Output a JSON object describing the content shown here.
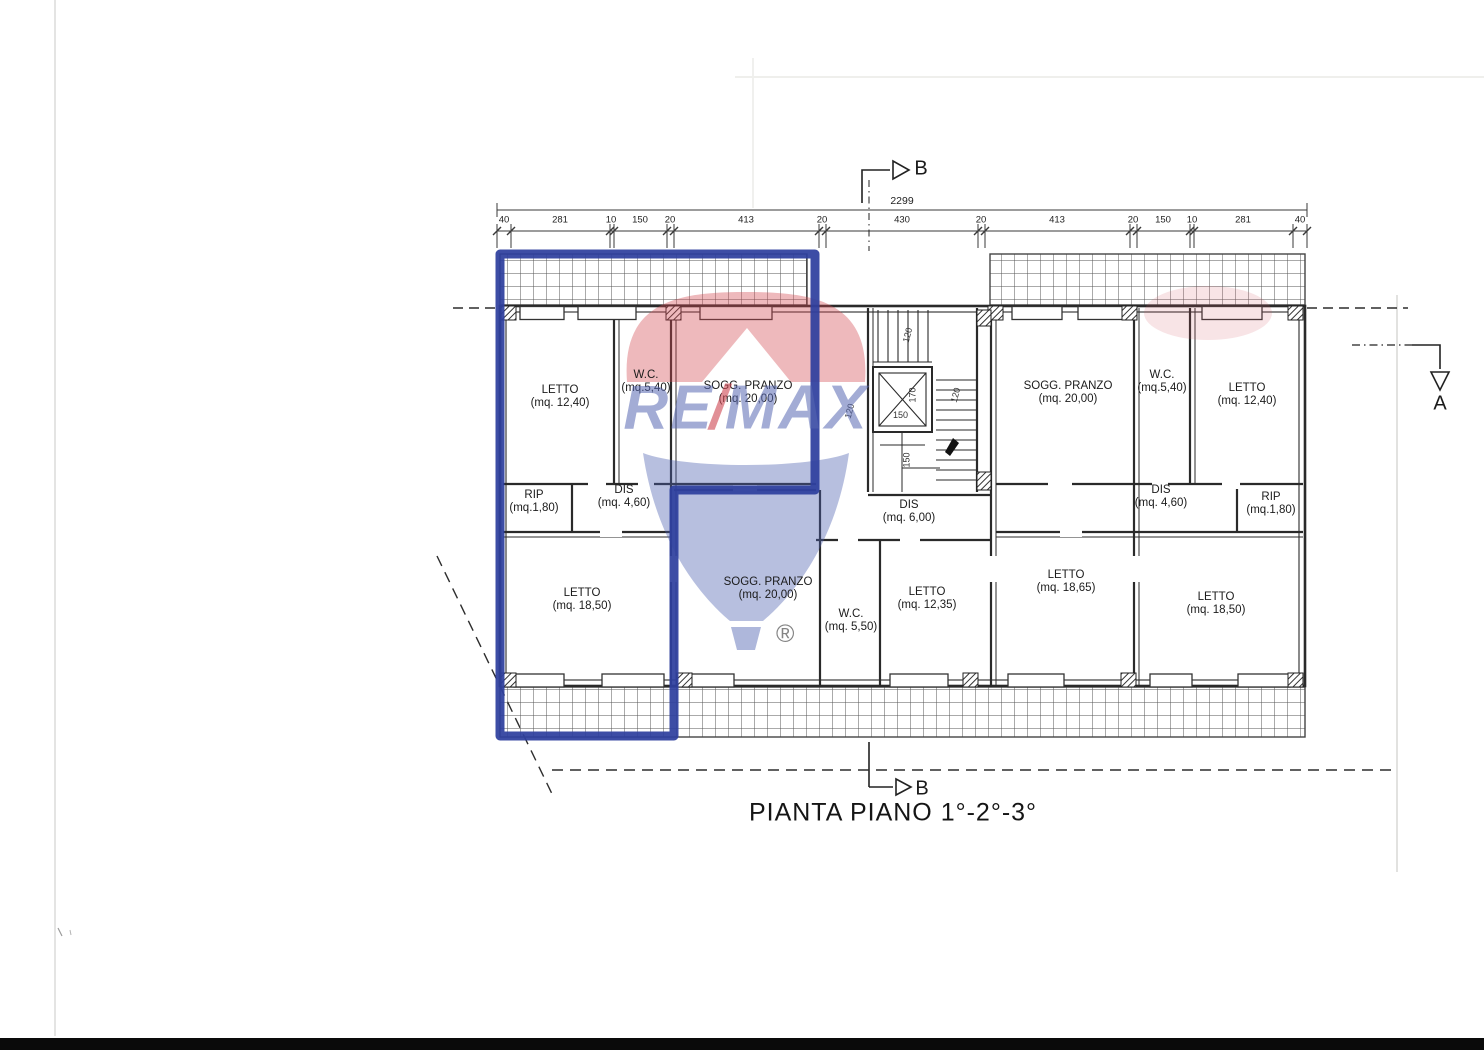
{
  "document": {
    "title": "PIANTA PIANO 1°-2°-3°"
  },
  "markers": {
    "section_b_top": "B",
    "section_b_bottom": "B",
    "section_a": "A"
  },
  "dimensions": {
    "overall": "2299",
    "segments": [
      "40",
      "281",
      "10",
      "150",
      "20",
      "413",
      "20",
      "430",
      "20",
      "413",
      "20",
      "150",
      "10",
      "281",
      "40"
    ],
    "stair": [
      "120",
      "170",
      "150",
      "120",
      "120",
      "150"
    ]
  },
  "rooms": [
    {
      "name": "LETTO",
      "area": "(mq. 12,40)"
    },
    {
      "name": "W.C.",
      "area": "(mq.5,40)"
    },
    {
      "name": "SOGG. PRANZO",
      "area": "(mq. 20,00)"
    },
    {
      "name": "SOGG. PRANZO",
      "area": "(mq. 20,00)"
    },
    {
      "name": "W.C.",
      "area": "(mq.5,40)"
    },
    {
      "name": "LETTO",
      "area": "(mq. 12,40)"
    },
    {
      "name": "RIP",
      "area": "(mq.1,80)"
    },
    {
      "name": "DIS",
      "area": "(mq. 4,60)"
    },
    {
      "name": "DIS",
      "area": "(mq. 6,00)"
    },
    {
      "name": "DIS",
      "area": "(mq. 4,60)"
    },
    {
      "name": "RIP",
      "area": "(mq.1,80)"
    },
    {
      "name": "LETTO",
      "area": "(mq. 18,50)"
    },
    {
      "name": "SOGG. PRANZO",
      "area": "(mq. 20,00)"
    },
    {
      "name": "W.C.",
      "area": "(mq. 5,50)"
    },
    {
      "name": "LETTO",
      "area": "(mq. 12,35)"
    },
    {
      "name": "LETTO",
      "area": "(mq. 18,65)"
    },
    {
      "name": "LETTO",
      "area": "(mq. 18,50)"
    }
  ],
  "watermark": {
    "part1": "RE",
    "slash": "/",
    "part2": "MAX",
    "registered": "®"
  },
  "colors": {
    "highlight_blue": "#2e3f9e",
    "watermark_red": "#d94f58",
    "watermark_blue": "#4b5faf",
    "line": "#2a2a2a"
  }
}
